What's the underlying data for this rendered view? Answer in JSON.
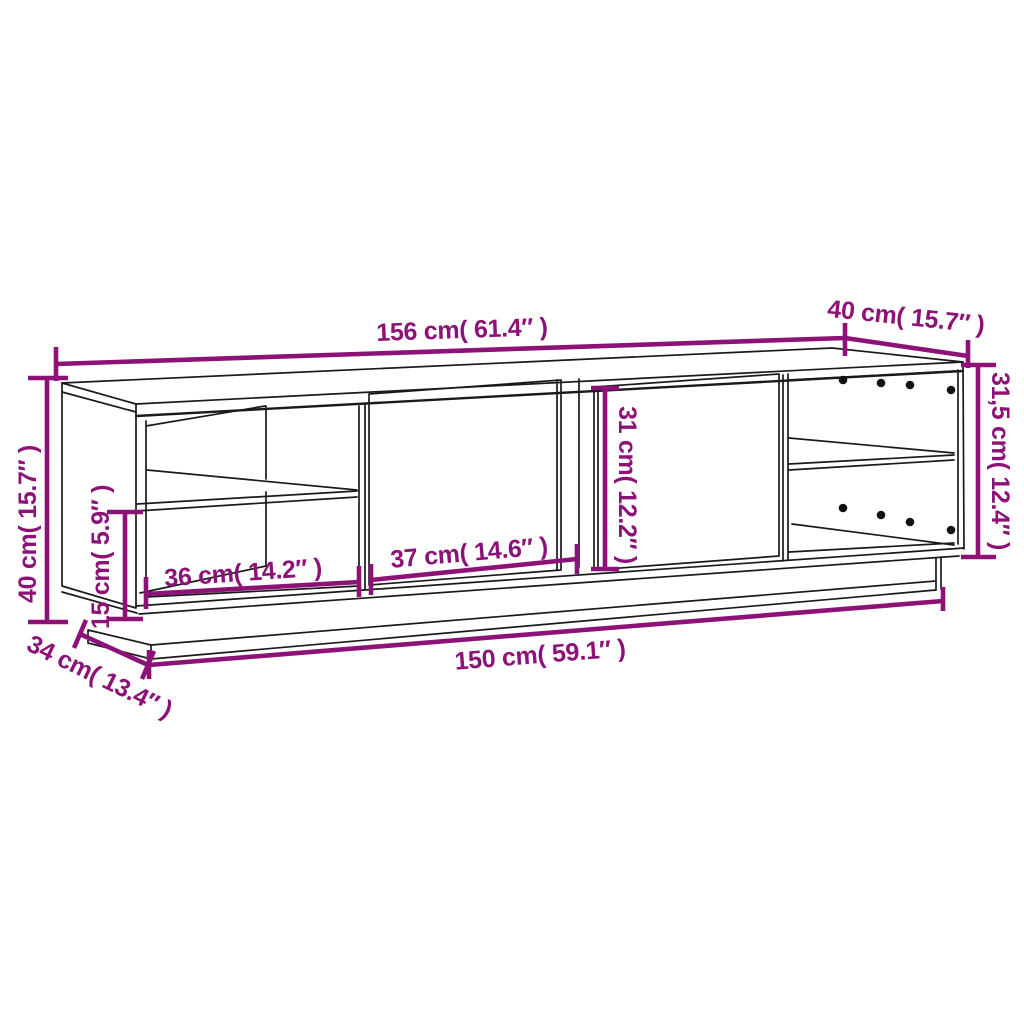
{
  "diagram": {
    "type": "furniture-dimension-diagram",
    "background_color": "#ffffff",
    "outline_color": "#1a1a1a",
    "accent_color": "#8D1277",
    "drawing": {
      "subject": "tv-cabinet-line-drawing",
      "sections": [
        "left-open-shelf-compartment",
        "two-doors",
        "right-open-shelf-compartment",
        "recessed-plinth"
      ],
      "shelf_pin_hole_rows": 2,
      "shelf_pin_holes_per_row": 4
    },
    "dims": {
      "top_width": {
        "label": "156 cm( 61.4″ )",
        "cm": 156,
        "inches": 61.4
      },
      "top_depth": {
        "label": "40 cm( 15.7″ )",
        "cm": 40,
        "inches": 15.7
      },
      "right_height": {
        "label": "31,5 cm( 12.4″ )",
        "cm": 31.5,
        "inches": 12.4
      },
      "left_height": {
        "label": "40 cm( 15.7″ )",
        "cm": 40,
        "inches": 15.7
      },
      "lower_opening_height": {
        "label": "15 cm( 5.9″ )",
        "cm": 15,
        "inches": 5.9
      },
      "left_compartment_width": {
        "label": "36 cm( 14.2″ )",
        "cm": 36,
        "inches": 14.2
      },
      "door_width": {
        "label": "37 cm( 14.6″ )",
        "cm": 37,
        "inches": 14.6
      },
      "door_height": {
        "label": "31 cm( 12.2″ )",
        "cm": 31,
        "inches": 12.2
      },
      "base_width": {
        "label": "150 cm( 59.1″ )",
        "cm": 150,
        "inches": 59.1
      },
      "base_depth": {
        "label": "34 cm( 13.4″ )",
        "cm": 34,
        "inches": 13.4
      }
    }
  }
}
